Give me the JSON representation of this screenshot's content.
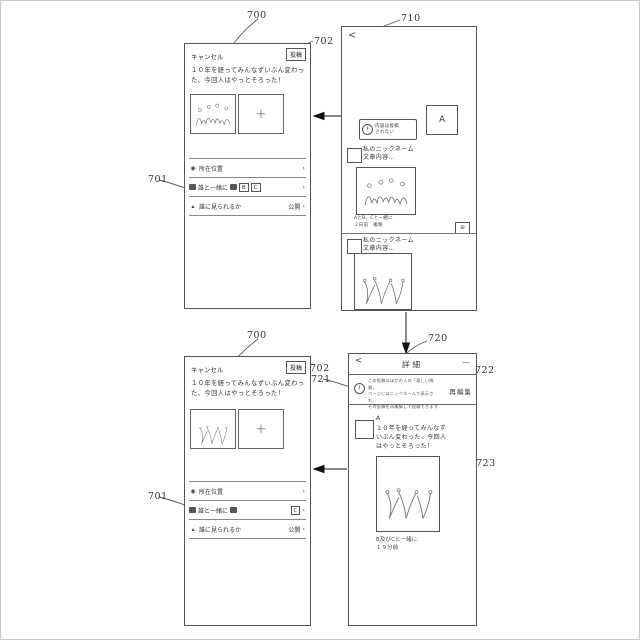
{
  "refs": {
    "screen_compose_top": "700",
    "post_top": "702",
    "rows_top": "701",
    "screen_list": "710",
    "list_notice": "711",
    "screen_compose_bottom": "700",
    "post_bottom": "702",
    "rows_bottom": "701",
    "screen_detail": "720",
    "detail_notice": "721",
    "reedit_ref": "722",
    "detail_image_ref": "723"
  },
  "compose_top": {
    "cancel_label": "キャンセル",
    "post_label": "投稿",
    "body": "１０年を経ってみんなずいぶん変わった、今回人はやっとそろった！",
    "add_label": "+",
    "row_location": {
      "icon": "◉",
      "label": "所在位置",
      "chevron": "›"
    },
    "row_with": {
      "label": "誰と一緒に",
      "badges": [
        "B",
        "C"
      ],
      "chevron": "›"
    },
    "row_visible": {
      "icon": "▴",
      "label": "誰に見られるか",
      "value": "公開",
      "chevron": "›"
    }
  },
  "compose_bottom": {
    "cancel_label": "キャンセル",
    "post_label": "投稿",
    "body": "１０年を経ってみんなずいぶん変わった、今回人はやっとそろった！",
    "add_label": "+",
    "row_location": {
      "icon": "◉",
      "label": "所在位置",
      "chevron": "›"
    },
    "row_with": {
      "label": "誰と一緒に",
      "badges": [
        "C"
      ],
      "chevron": "›"
    },
    "row_visible": {
      "icon": "▴",
      "label": "誰に見られるか",
      "value": "公開",
      "chevron": "›"
    }
  },
  "list_screen": {
    "back_label": "<",
    "notice_icon": "!",
    "notice_line1": "内容は投稿",
    "notice_line2": "されない",
    "avatar_label": "A",
    "items": [
      {
        "nickname": "私のニックネーム",
        "content": "文章内容…",
        "with_caption": "AとB、Cと一緒に",
        "time_caption": "２日前　複製",
        "badge": "⊞"
      },
      {
        "nickname": "私のニックネーム",
        "content": "文章内容…"
      }
    ]
  },
  "detail_screen": {
    "back_label": "<",
    "title": "詳細",
    "menu_label": "—",
    "notice_icon": "!",
    "notice_lines": [
      "この投稿はほかの人の「楽しい瞬間」",
      "ページにはニックネームで表示され、",
      "その投稿を再編集して投稿できます"
    ],
    "reedit_label": "再編集",
    "avatar_label": "A",
    "body": "１０年を経ってみんなずいぶん変わった、今回人はやっとそろった！",
    "with_caption": "B及びCと一緒に",
    "time_caption": "１９分前"
  }
}
